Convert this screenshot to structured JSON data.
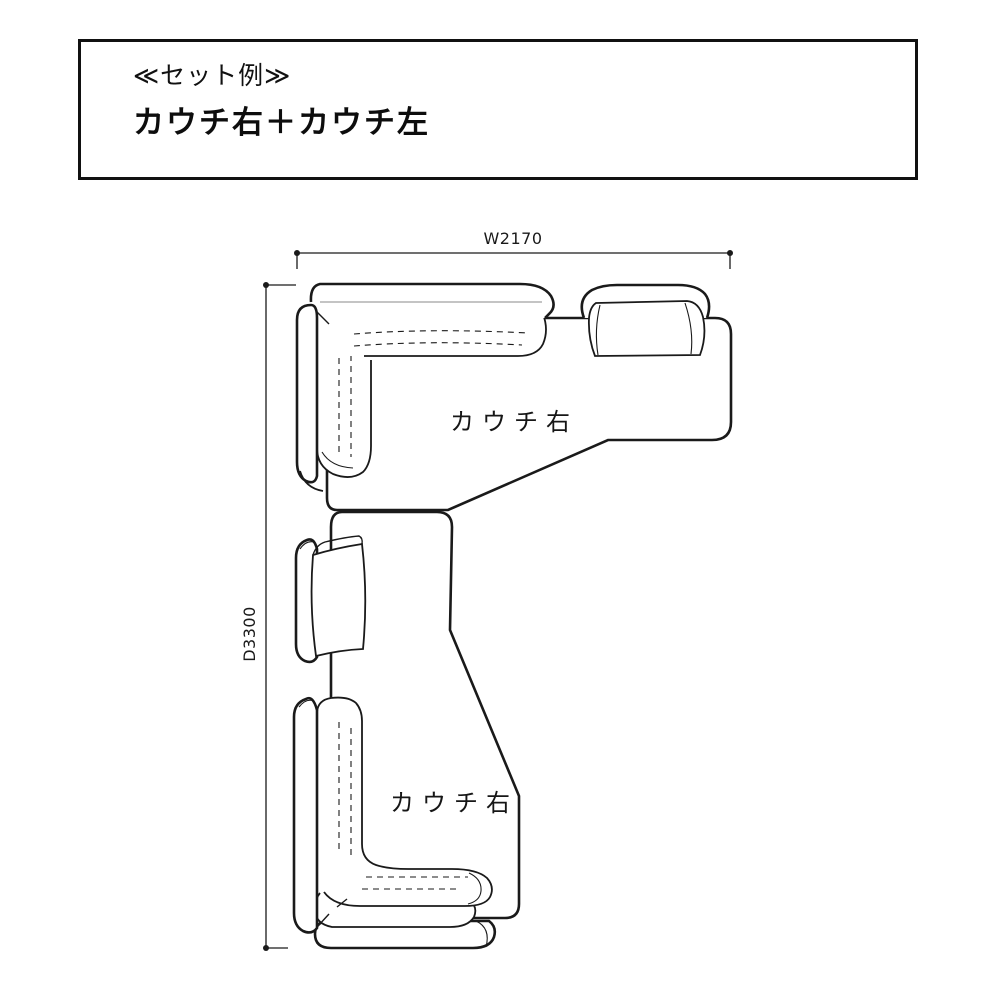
{
  "page": {
    "background": "#ffffff",
    "line_color": "#1a1a1a",
    "text_color": "#111111"
  },
  "header": {
    "line1": "≪セット例≫",
    "line2": "カウチ右＋カウチ左"
  },
  "diagram": {
    "width_dimension": "W2170",
    "depth_dimension": "D3300",
    "top_couch_label": "カウチ右",
    "bottom_couch_label": "カウチ右"
  }
}
